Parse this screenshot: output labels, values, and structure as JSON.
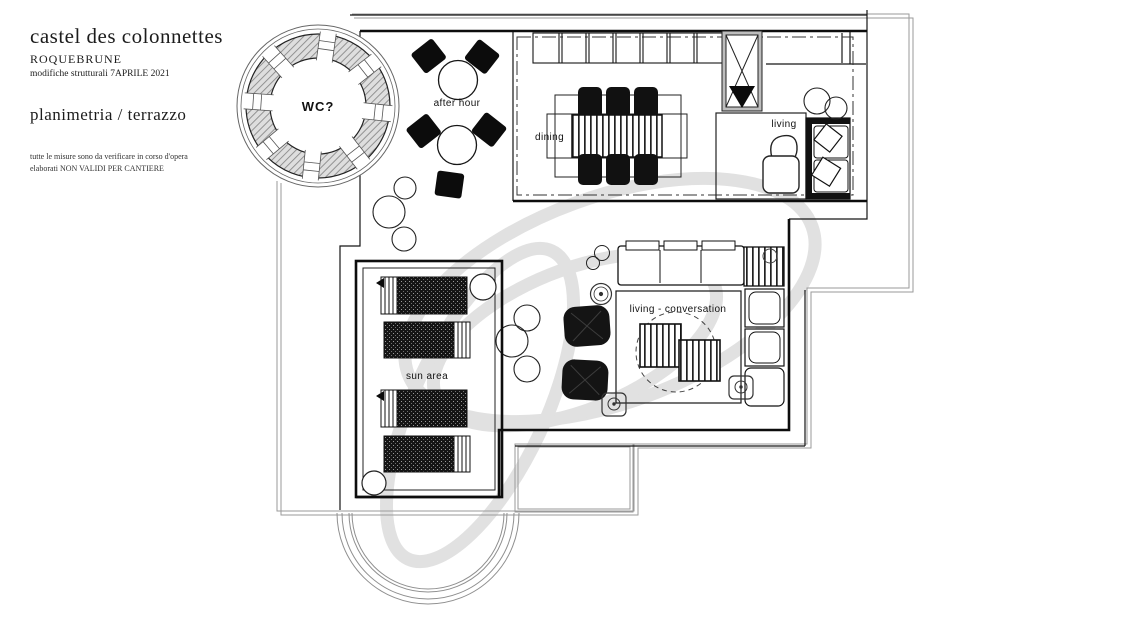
{
  "header": {
    "title": "castel des colonnettes",
    "subtitle": "ROQUEBRUNE",
    "revision": "modifiche strutturali 7APRILE 2021",
    "drawing_title": "planimetria / terrazzo",
    "disclaimer_line1": "tutte le misure sono da verificare in corso d'opera",
    "disclaimer_line2": "elaborati NON VALIDI PER CANTIERE"
  },
  "plan": {
    "labels": {
      "wc": "WC?",
      "after_hour": "after hour",
      "dining": "dining",
      "living": "living",
      "living_conversation": "living - conversation",
      "sun_area": "sun area"
    },
    "colors": {
      "line": "#1a1a1a",
      "hatch_fill": "#dedede",
      "hatch_line": "#8a8a8a",
      "watermark": "#c9c9c9"
    }
  }
}
